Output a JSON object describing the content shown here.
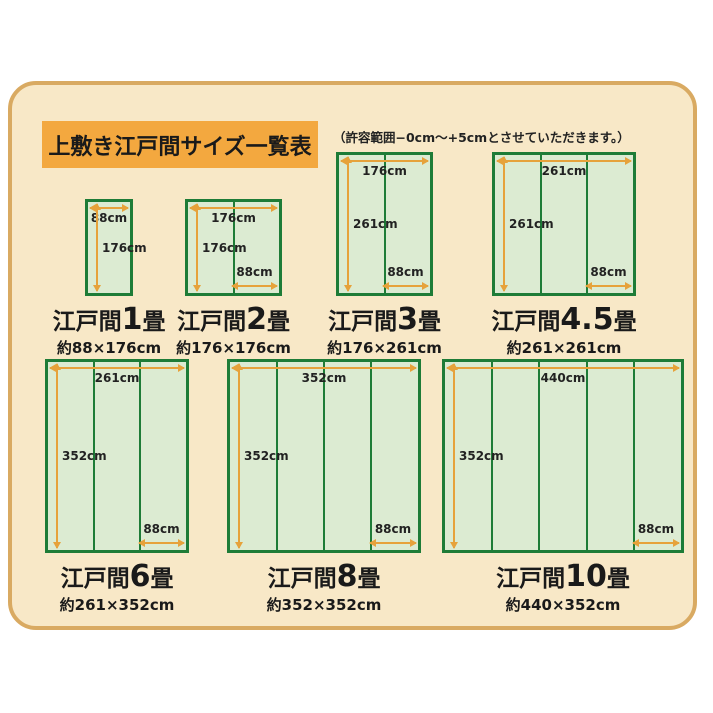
{
  "header": {
    "title": "上敷き江戸間サイズ一覧表",
    "note": "（許容範囲−0cm〜+5cmとさせていただきます。）"
  },
  "colors": {
    "card_bg": "#f8e8c7",
    "card_border": "#d9aa62",
    "title_bg": "#f3a83f",
    "mat_fill": "#dcebd2",
    "mat_border": "#1e7c37",
    "arrow": "#e6a23b"
  },
  "mats": [
    {
      "name_prefix": "江戸間",
      "name_num": "1",
      "name_suffix": "畳",
      "size": "約88×176cm",
      "top_label": "88cm",
      "left_label": "176cm",
      "panel_label": "",
      "panels": 1
    },
    {
      "name_prefix": "江戸間",
      "name_num": "2",
      "name_suffix": "畳",
      "size": "約176×176cm",
      "top_label": "176cm",
      "left_label": "176cm",
      "panel_label": "88cm",
      "panels": 2
    },
    {
      "name_prefix": "江戸間",
      "name_num": "3",
      "name_suffix": "畳",
      "size": "約176×261cm",
      "top_label": "176cm",
      "left_label": "261cm",
      "panel_label": "88cm",
      "panels": 2
    },
    {
      "name_prefix": "江戸間",
      "name_num": "4.5",
      "name_suffix": "畳",
      "size": "約261×261cm",
      "top_label": "261cm",
      "left_label": "261cm",
      "panel_label": "88cm",
      "panels": 3
    },
    {
      "name_prefix": "江戸間",
      "name_num": "6",
      "name_suffix": "畳",
      "size": "約261×352cm",
      "top_label": "261cm",
      "left_label": "352cm",
      "panel_label": "88cm",
      "panels": 3
    },
    {
      "name_prefix": "江戸間",
      "name_num": "8",
      "name_suffix": "畳",
      "size": "約352×352cm",
      "top_label": "352cm",
      "left_label": "352cm",
      "panel_label": "88cm",
      "panels": 4
    },
    {
      "name_prefix": "江戸間",
      "name_num": "10",
      "name_suffix": "畳",
      "size": "約440×352cm",
      "top_label": "440cm",
      "left_label": "352cm",
      "panel_label": "88cm",
      "panels": 5
    }
  ]
}
